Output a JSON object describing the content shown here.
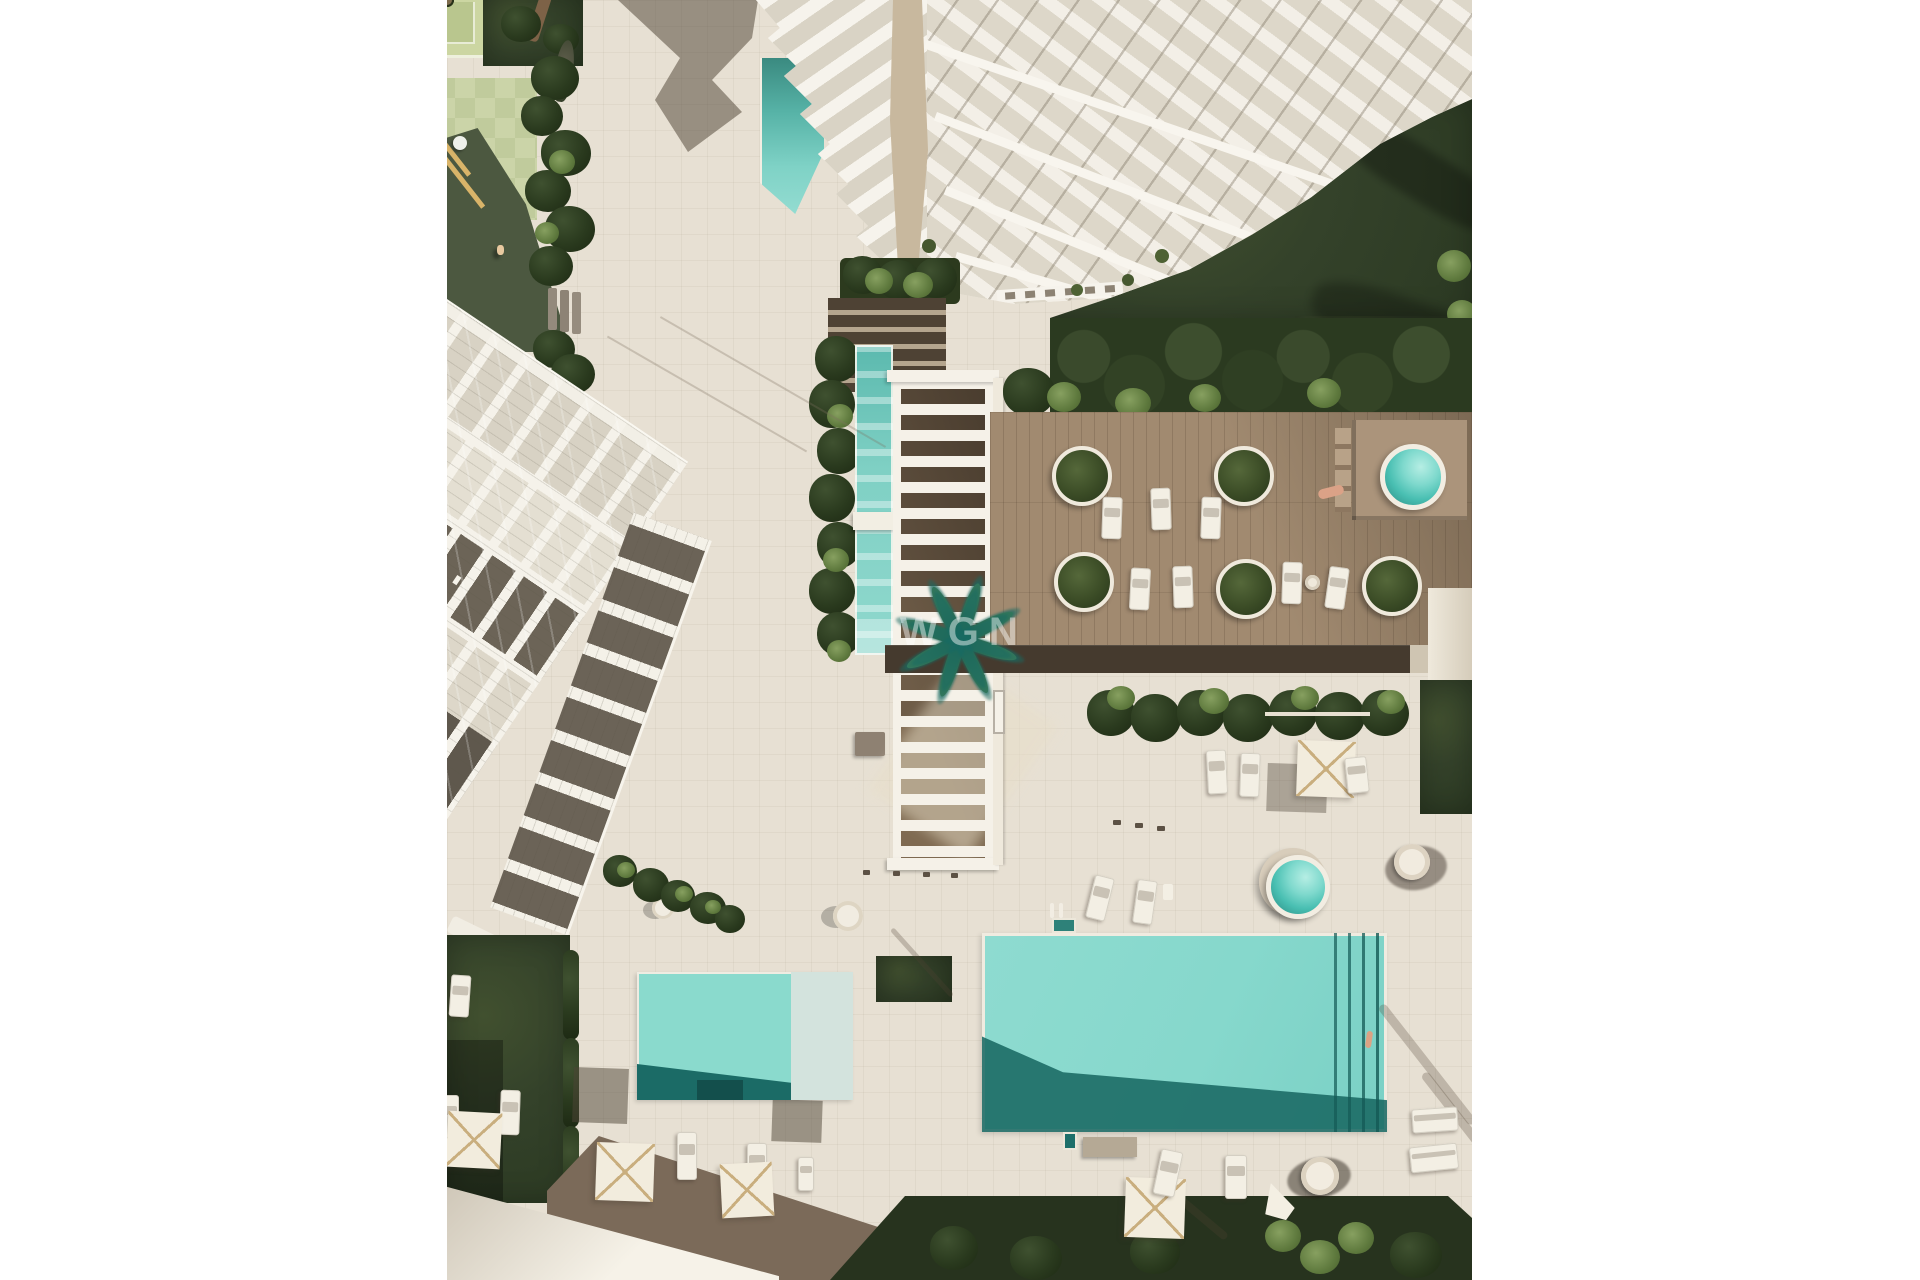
{
  "watermark": {
    "text": "WGN"
  },
  "scene": {
    "description": "Aerial top-down 3D architectural rendering of a coastal residential complex: a white high-rise tower at top, a diagonal row of white townhouses on the left, a slatted pergola over a lap pool, a hardwood sun deck with circular palm planters and a round spa, a large turquoise swimming pool and a smaller pool below, lawns, hedges, palm trees, parasols and sun loungers on beige paving",
    "palette": {
      "paving": "#e7e0d3",
      "paving_shadow": "#7b6a59",
      "deep_shadow_band": "#453a2e",
      "pool_water": "#86d8cc",
      "pool_deep": "#1d6f6a",
      "lap_pool": "#7fd0c4",
      "spa_water": "#49bfb2",
      "deck_wood": "#a18a70",
      "lawn": "#31402a",
      "hedge": "#26331b",
      "building_white": "#f5f2ea",
      "glass": "#d9d3c5",
      "terrace_dark": "#6b6357",
      "sand_wall": "#c8b89e",
      "playground_sun": "#cbd4a8",
      "playground_shade": "#4c5840",
      "road_light": "#f4f0e6",
      "parasol_rib": "#c9ae7e"
    },
    "features": [
      "white-tower",
      "townhouse-row",
      "pergola",
      "lap-pool",
      "wooden-deck",
      "round-spa",
      "main-pool",
      "secondary-pool",
      "jacuzzi",
      "hanging-chair",
      "playground",
      "palm-trees",
      "parasols",
      "sun-loungers",
      "hedges",
      "lawns"
    ]
  }
}
